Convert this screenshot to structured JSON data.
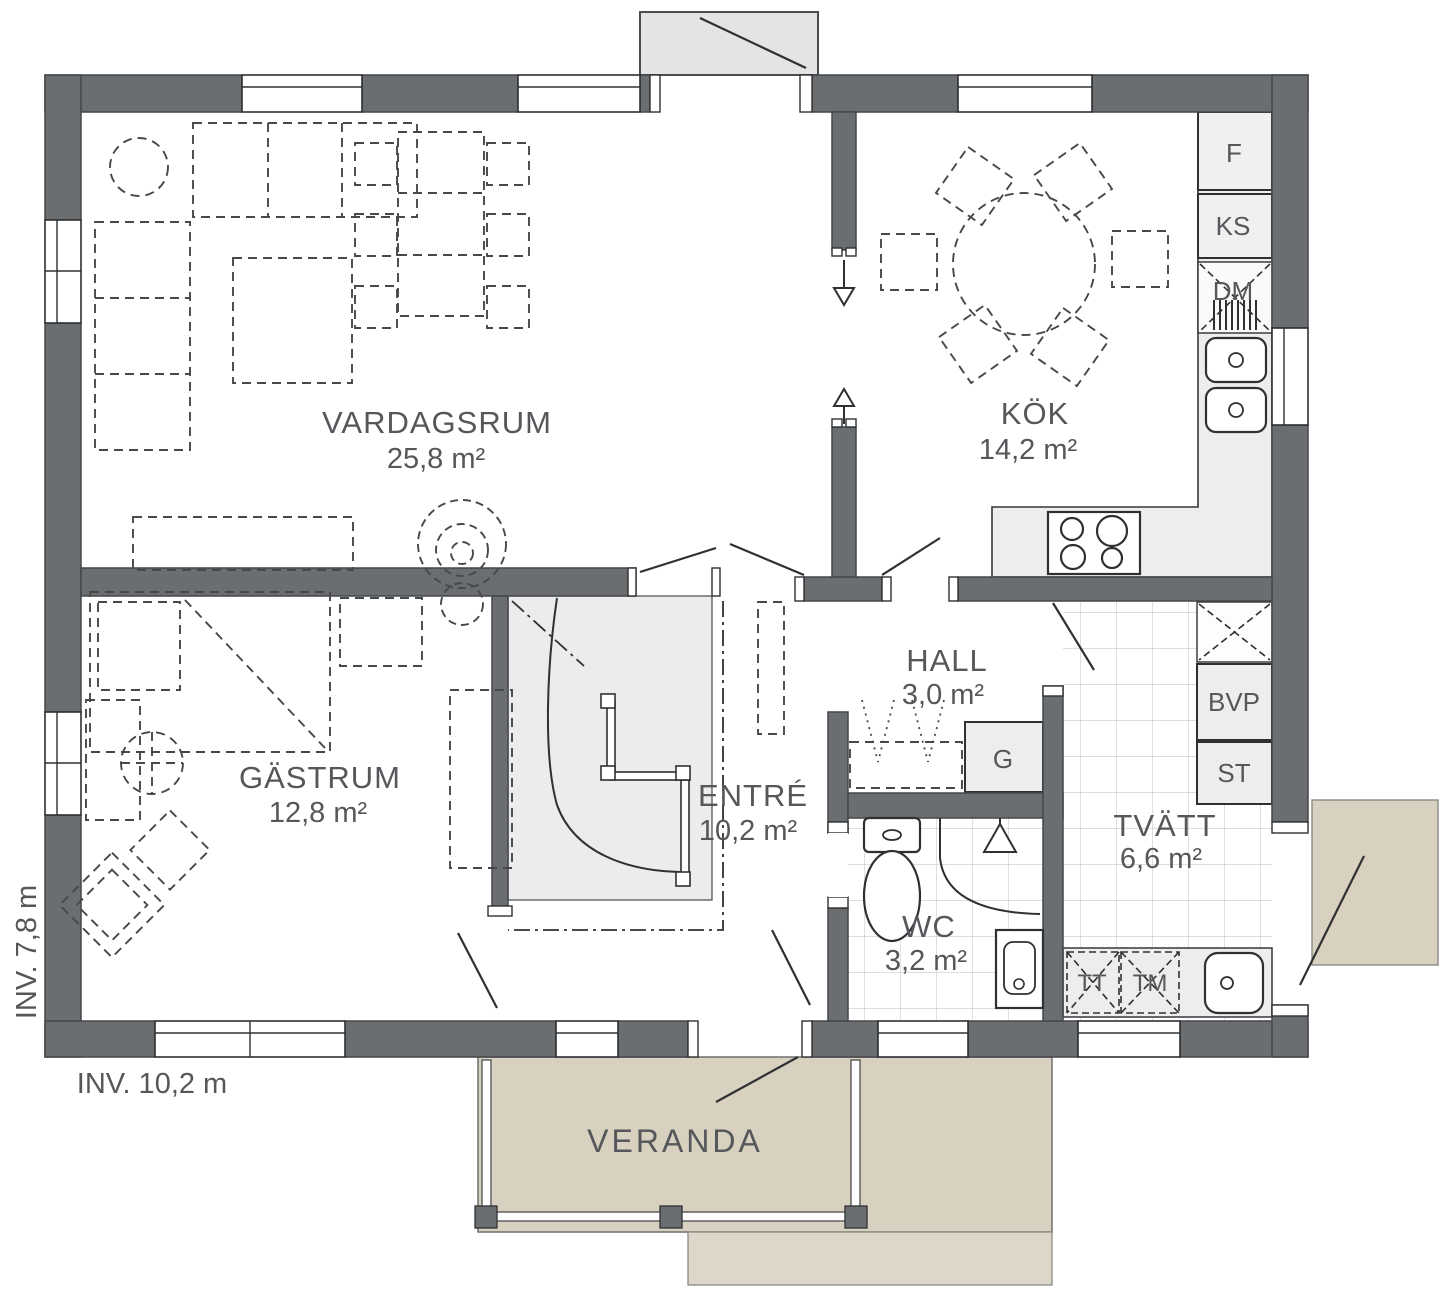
{
  "plan": {
    "title": "house-floor-plan",
    "rooms": {
      "vardagsrum": {
        "name": "VARDAGSRUM",
        "area": "25,8 m²"
      },
      "kok": {
        "name": "KÖK",
        "area": "14,2 m²"
      },
      "gastrum": {
        "name": "GÄSTRUM",
        "area": "12,8 m²"
      },
      "hall": {
        "name": "HALL",
        "area": "3,0 m²"
      },
      "entre": {
        "name": "ENTRÉ",
        "area": "10,2 m²"
      },
      "wc": {
        "name": "WC",
        "area": "3,2 m²"
      },
      "tvatt": {
        "name": "TVÄTT",
        "area": "6,6 m²"
      },
      "veranda": {
        "name": "VERANDA"
      }
    },
    "appliances": {
      "f": "F",
      "ks": "KS",
      "dm": "DM",
      "bvp": "BVP",
      "st": "ST",
      "g": "G",
      "tt": "TT",
      "tm": "TM"
    },
    "dimensions": {
      "width_label": "INV. 10,2 m",
      "depth_label": "INV. 7,8 m"
    },
    "colors": {
      "wall": "#6b6e71",
      "line": "#2f3032",
      "floor": "#ffffff",
      "fixture_fill": "#ededee",
      "stair_fill": "#ececec",
      "tile_line": "#c9c9c9",
      "veranda": "#d8d1c0",
      "veranda_step": "#ddd7c9",
      "canopy": "#e3e4e5",
      "text": "#55575a"
    }
  }
}
